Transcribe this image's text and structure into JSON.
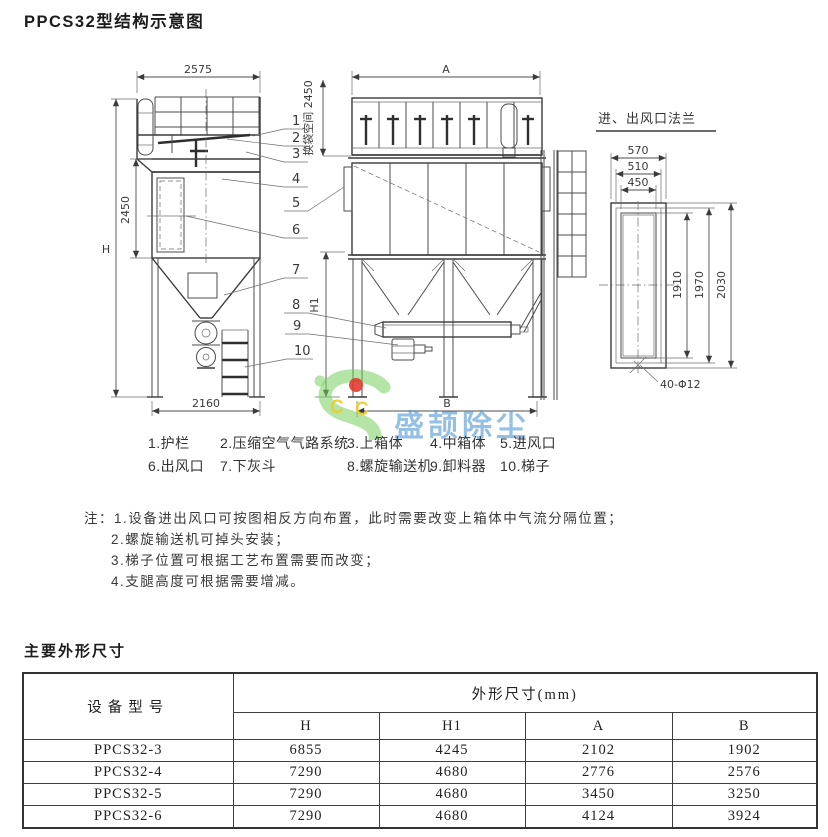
{
  "title": "PPCS32型结构示意图",
  "drawing": {
    "side_view": {
      "width": "2575",
      "bag_zone_height": "2450",
      "total_height": "H",
      "base_width": "2160",
      "support_height": "H1"
    },
    "front_view": {
      "width": "A",
      "base_width": "B",
      "bag_space": "换袋空间 2450"
    },
    "flange": {
      "title": "进、出风口法兰",
      "outer_width": "570",
      "bolt_width": "510",
      "opening_width": "450",
      "opening_height": "1910",
      "bolt_height": "1970",
      "outer_height": "2030",
      "bolt_holes": "40-Φ12"
    },
    "callouts": [
      "1",
      "2",
      "3",
      "4",
      "5",
      "6",
      "7",
      "8",
      "9",
      "10"
    ]
  },
  "watermark": {
    "logo_letter_1": "C",
    "logo_letter_2": "C",
    "brand": "盛颉除尘"
  },
  "legend": {
    "row1": [
      "1.护栏",
      "2.压缩空气气路系统",
      "3.上箱体",
      "4.中箱体",
      "5.进风口"
    ],
    "row2": [
      "6.出风口",
      "7.下灰斗",
      "8.螺旋输送机",
      "9.卸料器",
      "10.梯子"
    ]
  },
  "notes": {
    "label": "注：",
    "items": [
      "1.设备进出风口可按图相反方向布置，此时需要改变上箱体中气流分隔位置；",
      "2.螺旋输送机可掉头安装；",
      "3.梯子位置可根据工艺布置需要而改变；",
      "4.支腿高度可根据需要增减。"
    ]
  },
  "dimensions_section": {
    "title": "主要外形尺寸",
    "table": {
      "model_header": "设备型号",
      "group_header": "外形尺寸(mm)",
      "columns": [
        "H",
        "H1",
        "A",
        "B"
      ],
      "rows": [
        {
          "model": "PPCS32-3",
          "H": "6855",
          "H1": "4245",
          "A": "2102",
          "B": "1902"
        },
        {
          "model": "PPCS32-4",
          "H": "7290",
          "H1": "4680",
          "A": "2776",
          "B": "2576"
        },
        {
          "model": "PPCS32-5",
          "H": "7290",
          "H1": "4680",
          "A": "3450",
          "B": "3250"
        },
        {
          "model": "PPCS32-6",
          "H": "7290",
          "H1": "4680",
          "A": "4124",
          "B": "3924"
        }
      ]
    }
  }
}
